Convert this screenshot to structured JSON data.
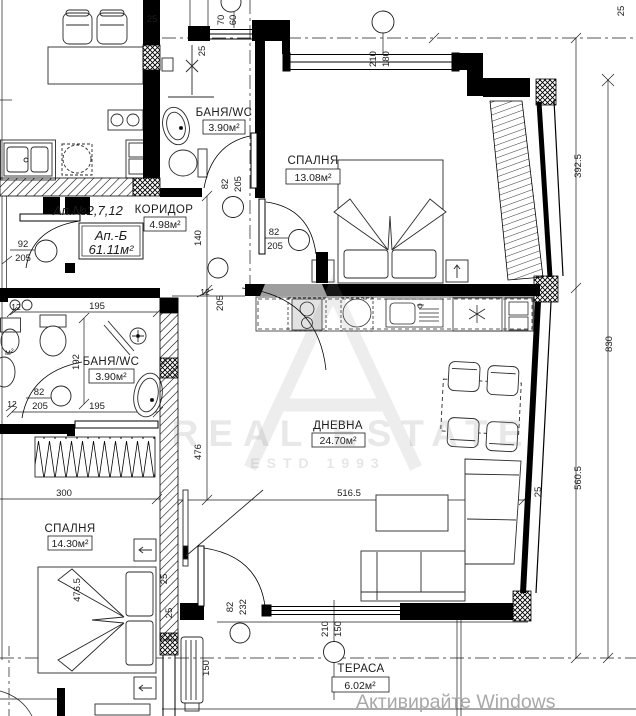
{
  "apartment": {
    "numbers": "Ап.№2,7,12",
    "name": "Ап.-Б",
    "area": "61.11м²"
  },
  "rooms": {
    "bath_top": {
      "name": "БАНЯ/WC",
      "area": "3.90м²"
    },
    "bedroom_top": {
      "name": "СПАЛНЯ",
      "area": "13.08м²"
    },
    "corridor": {
      "name": "КОРИДОР",
      "area": "4.98м²"
    },
    "bath_left": {
      "name": "БАНЯ/WC",
      "area": "3.90м²"
    },
    "bedroom_left": {
      "name": "СПАЛНЯ",
      "area": "14.30м²"
    },
    "living": {
      "name": "ДНЕВНА",
      "area": "24.70м²"
    },
    "terrace": {
      "name": "ТЕРАСА",
      "area": "6.02м²"
    },
    "neighbor_area_partial": "м²"
  },
  "dims": {
    "n12": "12",
    "n25": "25",
    "n60": "60",
    "n70": "70",
    "n82": "82",
    "n92": "92",
    "n140": "140",
    "n150": "150",
    "n180": "180",
    "n192": "192",
    "n195": "195",
    "n205": "205",
    "n210": "210",
    "n232": "232",
    "n300": "300",
    "n392_5": "392.5",
    "n476": "476",
    "n476_5": "476.5",
    "n516_5": "516.5",
    "n560_5": "560.5",
    "n830": "830"
  },
  "watermark": {
    "brand": "REAL ESTATE",
    "estd": "ESTD 1993"
  },
  "system": {
    "activate_windows": "Активирайте Windows"
  },
  "colors": {
    "wall": "#000000",
    "cabinet_gray": "#9e9e9e",
    "watermark_gray": "#e9e9e9",
    "activate_gray": "#a8a8a8"
  }
}
